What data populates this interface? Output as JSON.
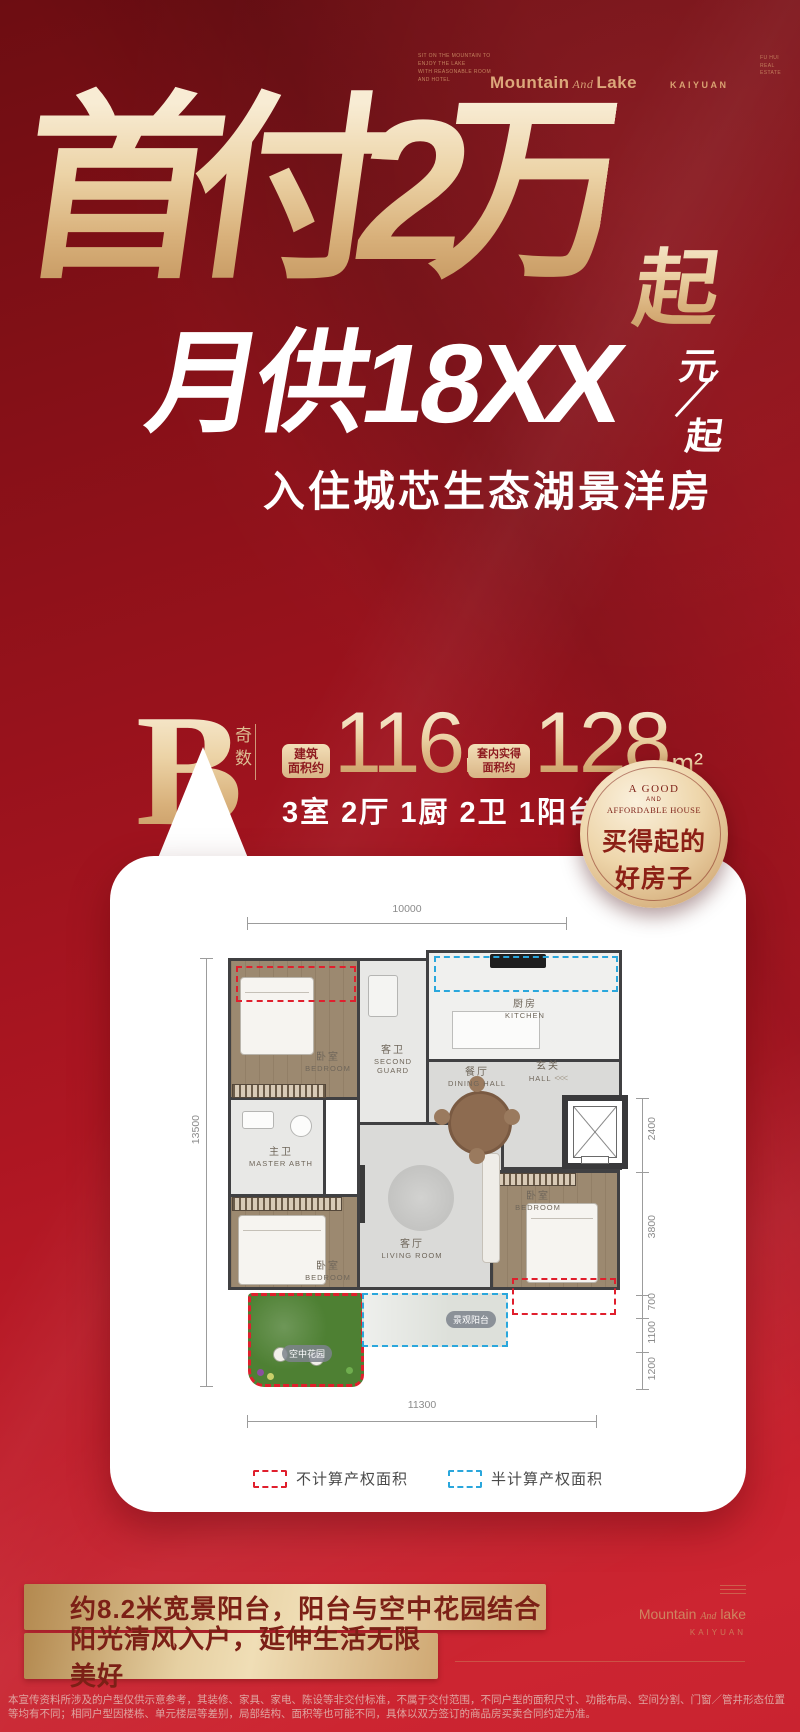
{
  "header": {
    "tagline_lines": [
      "SIT ON THE MOUNTAIN TO",
      "ENJOY THE LAKE",
      "WITH REASONABLE ROOM",
      "AND HOTEL"
    ],
    "brand_left": "Mountain",
    "brand_and": "And",
    "brand_right": "Lake",
    "kaiyuan": "KAIYUAN",
    "corner_lines": [
      "FU HUI",
      "REAL",
      "ESTATE"
    ]
  },
  "hero": {
    "title_main": "首付2万",
    "title_suffix": "起",
    "monthly": "月供18XX",
    "unit_top": "元",
    "unit_bottom": "起",
    "subtitle": "入住城芯生态湖景洋房"
  },
  "unit": {
    "type_letter": "B",
    "type_note": "奇数",
    "area1_label_line1": "建筑",
    "area1_label_line2": "面积约",
    "area1_value": "116",
    "area1_unit": "m²",
    "area2_label_line1": "套内实得",
    "area2_label_line2": "面积约",
    "area2_value": "128",
    "area2_unit": "m²",
    "layout_desc": "3室 2厅 1厨 2卫 1阳台1花园"
  },
  "badge": {
    "line1": "A GOOD",
    "line2": "AND",
    "line3": "AFFORDABLE HOUSE",
    "line4": "买得起的",
    "line5": "好房子",
    "gold_color": "#e9cfa2",
    "text_color": "#8c2016"
  },
  "floorplan": {
    "dim_top": "10000",
    "dim_left": "13500",
    "dim_bottom": "11300",
    "dims_right": [
      "2400",
      "3800",
      "700",
      "1100",
      "1200"
    ],
    "rooms": {
      "bedroom_top": {
        "zh": "卧室",
        "en": "BEDROOM"
      },
      "second_guard": {
        "zh": "客卫",
        "en": "SECOND GUARD"
      },
      "kitchen": {
        "zh": "厨房",
        "en": "KITCHEN"
      },
      "dining": {
        "zh": "餐厅",
        "en": "DINING HALL"
      },
      "hall": {
        "zh": "玄关",
        "en": "HALL"
      },
      "hall_arrows": "<<<",
      "master_bath": {
        "zh": "主卫",
        "en": "MASTER ABTH"
      },
      "bedroom_left": {
        "zh": "卧室",
        "en": "BEDROOM"
      },
      "living": {
        "zh": "客厅",
        "en": "LIVING ROOM"
      },
      "bedroom_right": {
        "zh": "卧室",
        "en": "BEDROOM"
      }
    },
    "garden_label": "空中花园",
    "balcony_label": "景观阳台",
    "legend": [
      {
        "label": "不计算产权面积",
        "color": "#e01f2d"
      },
      {
        "label": "半计算产权面积",
        "color": "#2aa7dc"
      }
    ]
  },
  "features": [
    "约8.2米宽景阳台，阳台与空中花园结合",
    "阳光清风入户，延伸生活无限美好"
  ],
  "footer_logo": {
    "brand_left": "Mountain",
    "brand_and": "And",
    "brand_right": "lake",
    "sub": "KAIYUAN"
  },
  "disclaimer": "本宣传资料所涉及的户型仅供示意参考，其装修、家具、家电、陈设等非交付标准，不属于交付范围，不同户型的面积尺寸、功能布局、空间分割、门窗／管井形态位置等均有不同；相同户型因楼栋、单元楼层等差别，局部结构、面积等也可能不同，具体以双方签订的商品房买卖合同约定为准。",
  "colors": {
    "background_red": "#a81520",
    "champagne_gold": "#e9cfa2",
    "bar_text": "#7c2016",
    "red_dashed": "#e01f2d",
    "blue_dashed": "#2aa7dc"
  }
}
